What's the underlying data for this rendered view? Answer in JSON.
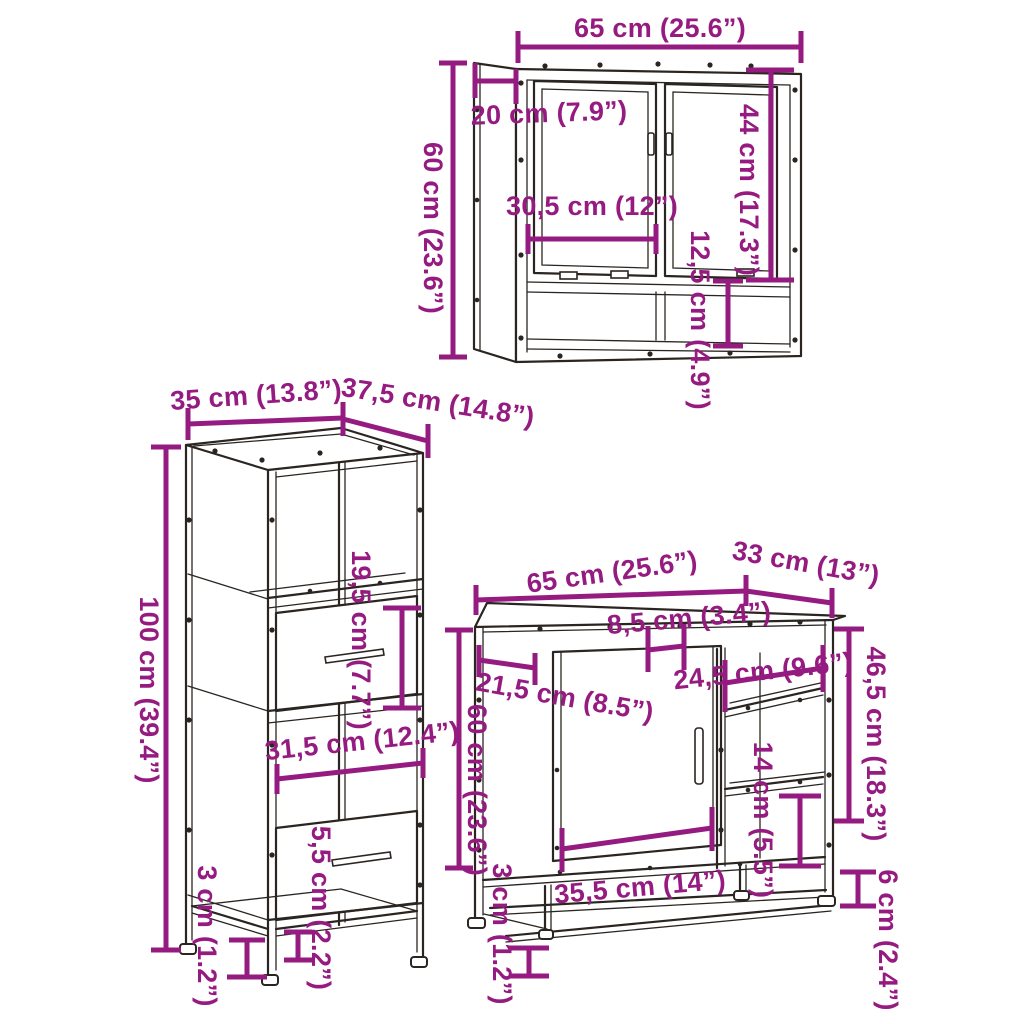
{
  "colors": {
    "dimension": "#951B81",
    "line_art": "#2B2521",
    "background": "#FFFFFF"
  },
  "mirror_cabinet": {
    "width": "65 cm (25.6”)",
    "depth": "20 cm (7.9”)",
    "height": "60 cm (23.6”)",
    "door_width": "30,5 cm (12”)",
    "door_height": "44 cm (17.3”)",
    "shelf_height": "12,5 cm (4.9”)"
  },
  "tall_cabinet": {
    "width": "35 cm (13.8”)",
    "depth": "37,5 cm (14.8”)",
    "height": "100 cm (39.4”)",
    "drawer_height": "19,5 cm (7.7”)",
    "drawer_width": "31,5 cm (12.4”)",
    "plinth_height": "5,5 cm (2.2”)",
    "leg_height": "3 cm (1.2”)"
  },
  "sink_cabinet": {
    "width": "65 cm (25.6”)",
    "depth": "33 cm (13”)",
    "height": "60 cm (23.6”)",
    "top_gap": "8,5 cm (3.4”)",
    "side_depth": "21,5 cm (8.5”)",
    "shelf_width": "24,5 cm (9.6”)",
    "open_side_height": "46,5 cm (18.3”)",
    "shelf_gap": "14 cm (5.5”)",
    "door_width": "35,5 cm (14”)",
    "leg_height": "3 cm (1.2”)",
    "bottom_gap": "6 cm (2.4”)"
  }
}
